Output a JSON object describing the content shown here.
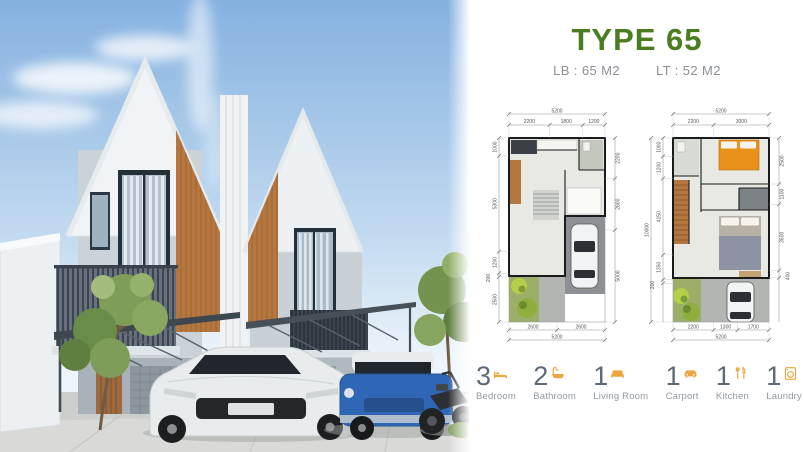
{
  "colors": {
    "title-green": "#4a7d1f",
    "accent-orange": "#eda53f",
    "number-slate": "#5b6a76",
    "label-gray": "#9199a1",
    "plan-wall": "#1a1b1d"
  },
  "header": {
    "title": "TYPE 65",
    "building_area": "LB : 65 M2",
    "land_area": "LT : 52 M2"
  },
  "floor_plans": {
    "ground_floor": {
      "name": "Ground floor plan",
      "top_total": "5200",
      "top_segments": [
        "2200",
        "1800",
        "1200"
      ],
      "left_segments": [
        "1000",
        "5300",
        "1200",
        "200",
        "2500"
      ],
      "right_segments": [
        "2200",
        "2800",
        "5000"
      ],
      "bottom_segments": [
        "2600",
        "2600"
      ],
      "bottom_total": "5200"
    },
    "upper_floor": {
      "name": "Upper floor plan",
      "top_total": "5200",
      "top_segments": [
        "2200",
        "3000"
      ],
      "left_total": "10000",
      "left_segments": [
        "1000",
        "1200",
        "4150",
        "1350",
        "200"
      ],
      "right_segments": [
        "2500",
        "1100",
        "3600",
        "400"
      ],
      "bottom_segments": [
        "2200",
        "1300",
        "1700"
      ],
      "bottom_total": "5200"
    }
  },
  "amenities": [
    {
      "count": "3",
      "label": "Bedroom",
      "icon": "bed-icon"
    },
    {
      "count": "2",
      "label": "Bathroom",
      "icon": "shower-icon"
    },
    {
      "count": "1",
      "label": "Living Room",
      "icon": "sofa-icon"
    },
    {
      "count": "1",
      "label": "Carport",
      "icon": "car-icon"
    },
    {
      "count": "1",
      "label": "Kitchen",
      "icon": "utensils-icon"
    },
    {
      "count": "1",
      "label": "Laundry",
      "icon": "washing-machine-icon"
    }
  ]
}
